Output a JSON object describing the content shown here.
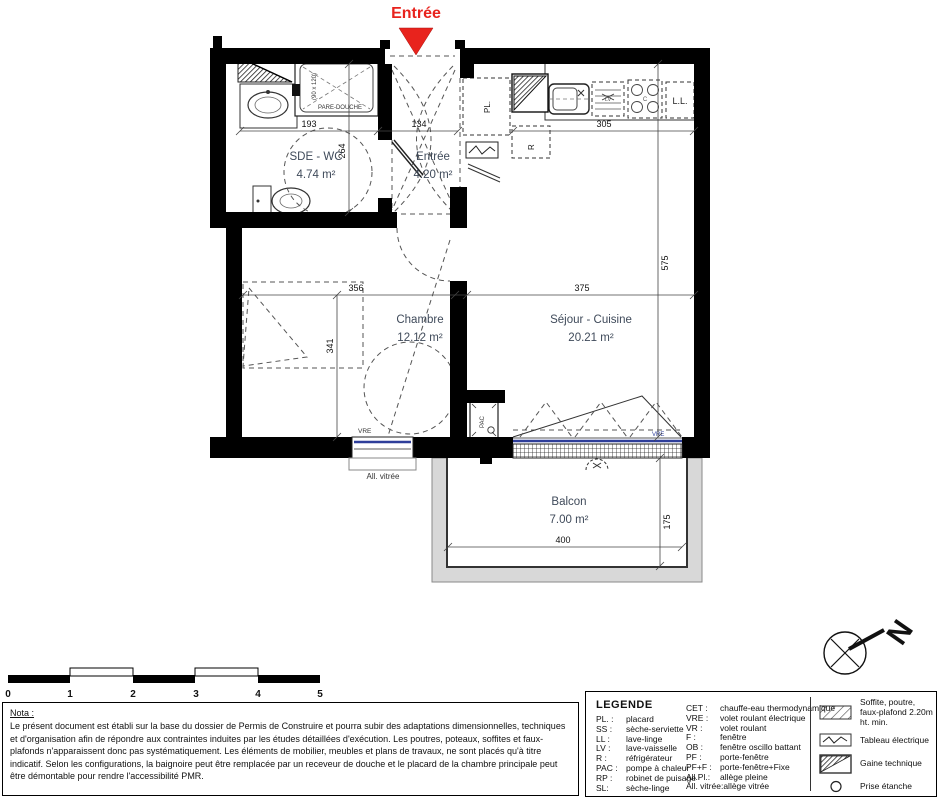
{
  "colors": {
    "accent_red": "#e8231d",
    "glazing_blue": "#2e3e9a",
    "wall_black": "#000000",
    "balcony_gray": "#d8d8d8",
    "room_label": "#3f4a5a"
  },
  "plan": {
    "entry_title": "Entrée",
    "rooms": [
      {
        "name": "SDE - WC",
        "area": "4.74 m²"
      },
      {
        "name": "Entrée",
        "area": "4.20 m²"
      },
      {
        "name": "Chambre",
        "area": "12.12 m²"
      },
      {
        "name": "Séjour - Cuisine",
        "area": "20.21 m²"
      },
      {
        "name": "Balcon",
        "area": "7.00 m²"
      }
    ],
    "dims": {
      "d193": "193",
      "d134": "134",
      "d305": "305",
      "d264": "264",
      "d575": "575",
      "d356": "356",
      "d341": "341",
      "d375": "375",
      "d400": "400",
      "d175": "175"
    },
    "labels": {
      "pl": "PL.",
      "fridge": "R",
      "washer": "L.L.",
      "dishwasher": "LV",
      "cooktop": "C",
      "shower_screen": "PARE-DOUCHE",
      "shower_size": "(90 x 120)",
      "vre": "VRE",
      "glazed_sill": "All. vitrée",
      "heat_pump": "PAC",
      "north": "N"
    }
  },
  "scale_bar": {
    "ticks": [
      "0",
      "1",
      "2",
      "3",
      "4",
      "5"
    ]
  },
  "nota": {
    "title": "Nota :",
    "body": "Le présent document est établi sur la base du dossier de Permis de Construire et pourra subir des adaptations dimensionnelles, techniques et d'organisation afin de répondre aux contraintes induites par les études détaillées d'exécution. Les poutres, poteaux, soffites et faux-plafonds n'apparaissent donc pas systématiquement. Les éléments de mobilier, meubles et plans de travaux, ne sont placés qu'à titre indicatif. Selon les configurations, la baignoire peut être remplacée par un receveur de douche et le placard de la chambre principale peut être démontable pour rendre l'accessibilité PMR."
  },
  "legend": {
    "title": "LEGENDE",
    "col1": [
      {
        "abbr": "PL. :",
        "label": "placard"
      },
      {
        "abbr": "SS :",
        "label": "sèche-serviette"
      },
      {
        "abbr": "LL :",
        "label": "lave-linge"
      },
      {
        "abbr": "LV :",
        "label": "lave-vaisselle"
      },
      {
        "abbr": "R :",
        "label": "réfrigérateur"
      },
      {
        "abbr": "PAC :",
        "label": "pompe à chaleur"
      },
      {
        "abbr": "RP :",
        "label": "robinet de puisage"
      },
      {
        "abbr": "SL:",
        "label": "sèche-linge"
      }
    ],
    "col2": [
      {
        "abbr": "CET :",
        "label": "chauffe-eau thermodynamique"
      },
      {
        "abbr": "VRE :",
        "label": "volet roulant électrique"
      },
      {
        "abbr": "VR :",
        "label": "volet roulant"
      },
      {
        "abbr": "F :",
        "label": "fenêtre"
      },
      {
        "abbr": "OB :",
        "label": "fenêtre oscillo battant"
      },
      {
        "abbr": "PF :",
        "label": "porte-fenêtre"
      },
      {
        "abbr": "PF+F :",
        "label": "porte-fenêtre+Fixe"
      },
      {
        "abbr": "All.Pl.:",
        "label": "allège pleine"
      },
      {
        "abbr": "All. vitrée:",
        "label": "allège vitrée"
      }
    ],
    "symbols": [
      {
        "label": "Soffite, poutre, faux-plafond 2.20m ht. min."
      },
      {
        "label": "Tableau électrique"
      },
      {
        "label": "Gaine technique"
      },
      {
        "label": "Prise étanche"
      },
      {
        "label": "Applique extérieure"
      }
    ]
  }
}
